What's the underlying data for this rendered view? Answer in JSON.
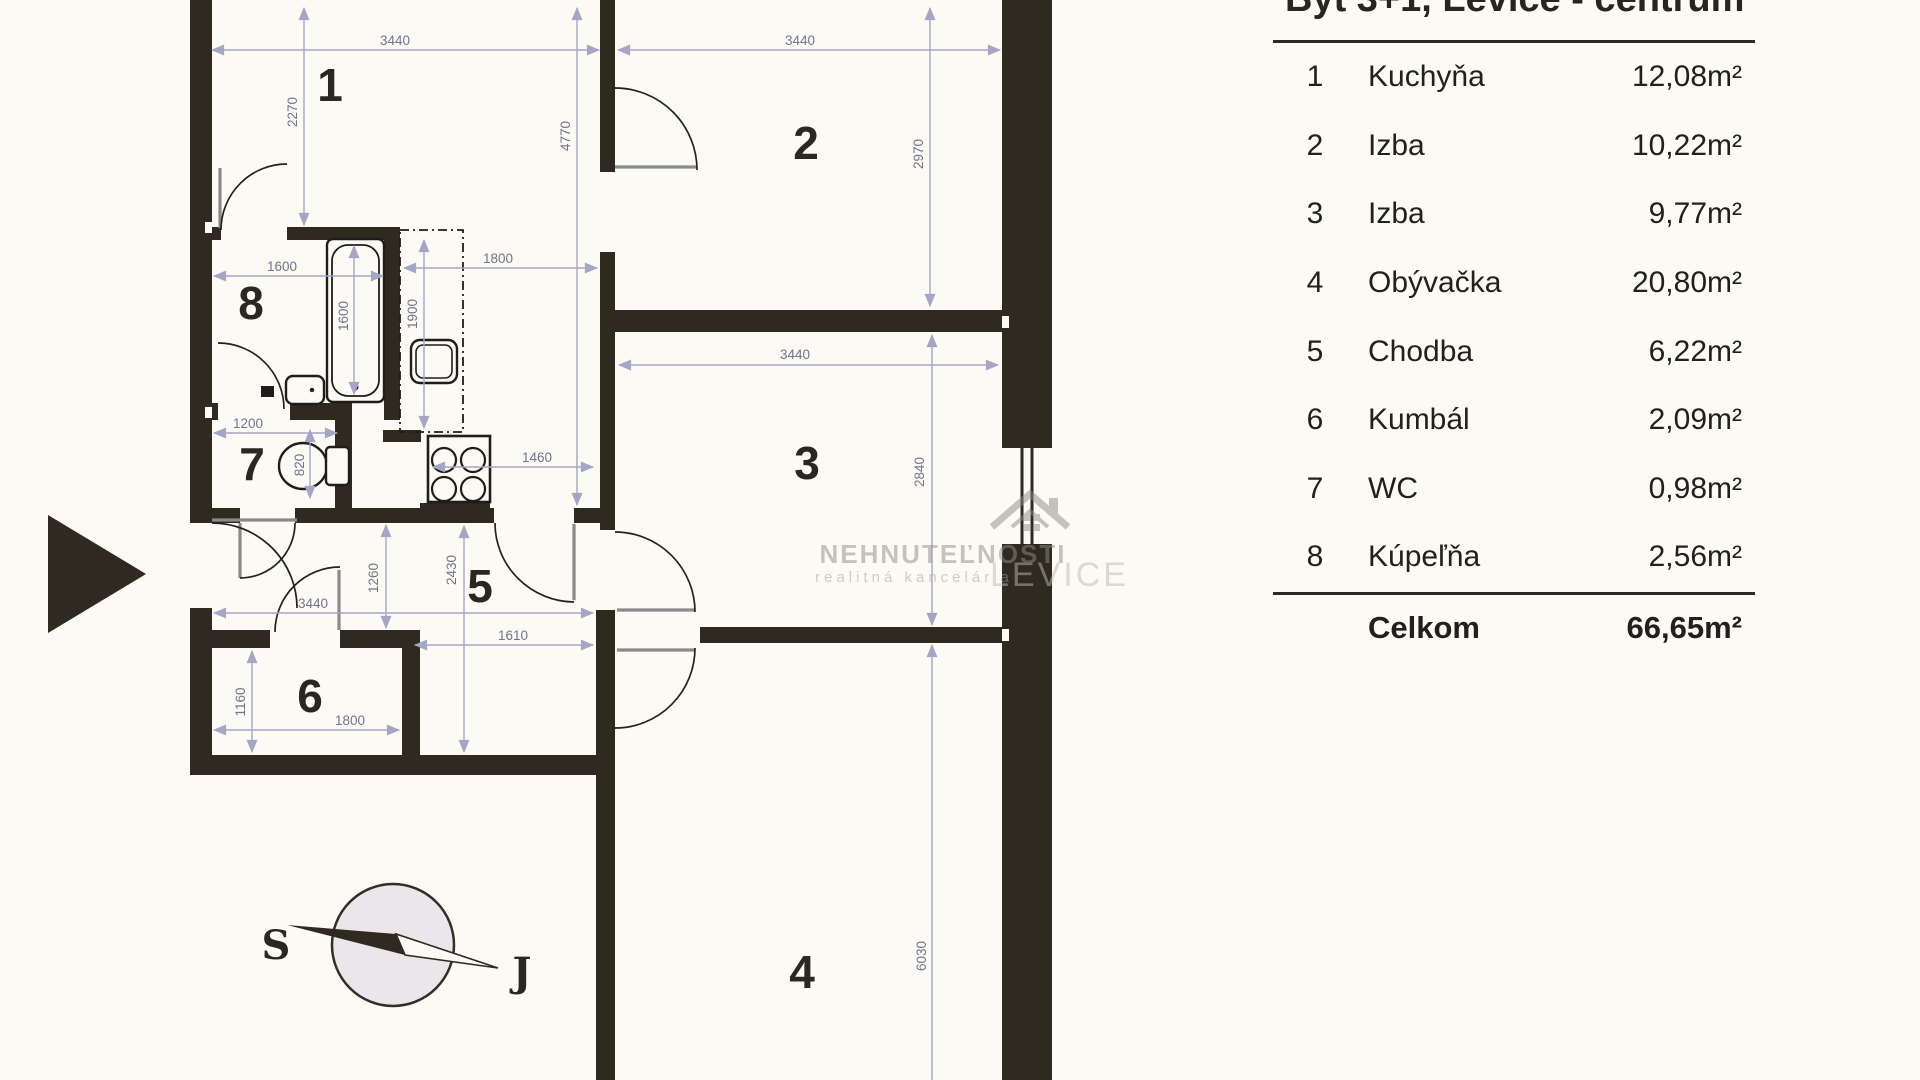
{
  "header": {
    "title": "Byt 3+1, Levice - centrum"
  },
  "legend": {
    "rows": [
      {
        "num": "1",
        "name": "Kuchyňa",
        "area": "12,08m²"
      },
      {
        "num": "2",
        "name": "Izba",
        "area": "10,22m²"
      },
      {
        "num": "3",
        "name": "Izba",
        "area": "9,77m²"
      },
      {
        "num": "4",
        "name": "Obývačka",
        "area": "20,80m²"
      },
      {
        "num": "5",
        "name": "Chodba",
        "area": "6,22m²"
      },
      {
        "num": "6",
        "name": "Kumbál",
        "area": "2,09m²"
      },
      {
        "num": "7",
        "name": "WC",
        "area": "0,98m²"
      },
      {
        "num": "8",
        "name": "Kúpeľňa",
        "area": "2,56m²"
      }
    ],
    "total_label": "Celkom",
    "total_area": "66,65m²"
  },
  "plan": {
    "room_labels": [
      "1",
      "2",
      "3",
      "4",
      "5",
      "6",
      "7",
      "8"
    ],
    "dim_labels": [
      "3440",
      "3440",
      "2270",
      "4770",
      "2970",
      "1600",
      "1800",
      "1600",
      "1900",
      "1200",
      "820",
      "1460",
      "1260",
      "2430",
      "3440",
      "1610",
      "1160",
      "1800",
      "3440",
      "2840",
      "6030"
    ],
    "compass": {
      "north_label": "S",
      "south_label": "J"
    },
    "watermark": {
      "line1": "NEHNUTEĽNOSTI",
      "line2": "realitná kancelária",
      "line3": "LEVICE"
    },
    "colors": {
      "wall": "#2f2a1f",
      "background": "#fcfaf4",
      "dimension": "#a5a5c5",
      "dimension_text": "#73738c"
    }
  }
}
